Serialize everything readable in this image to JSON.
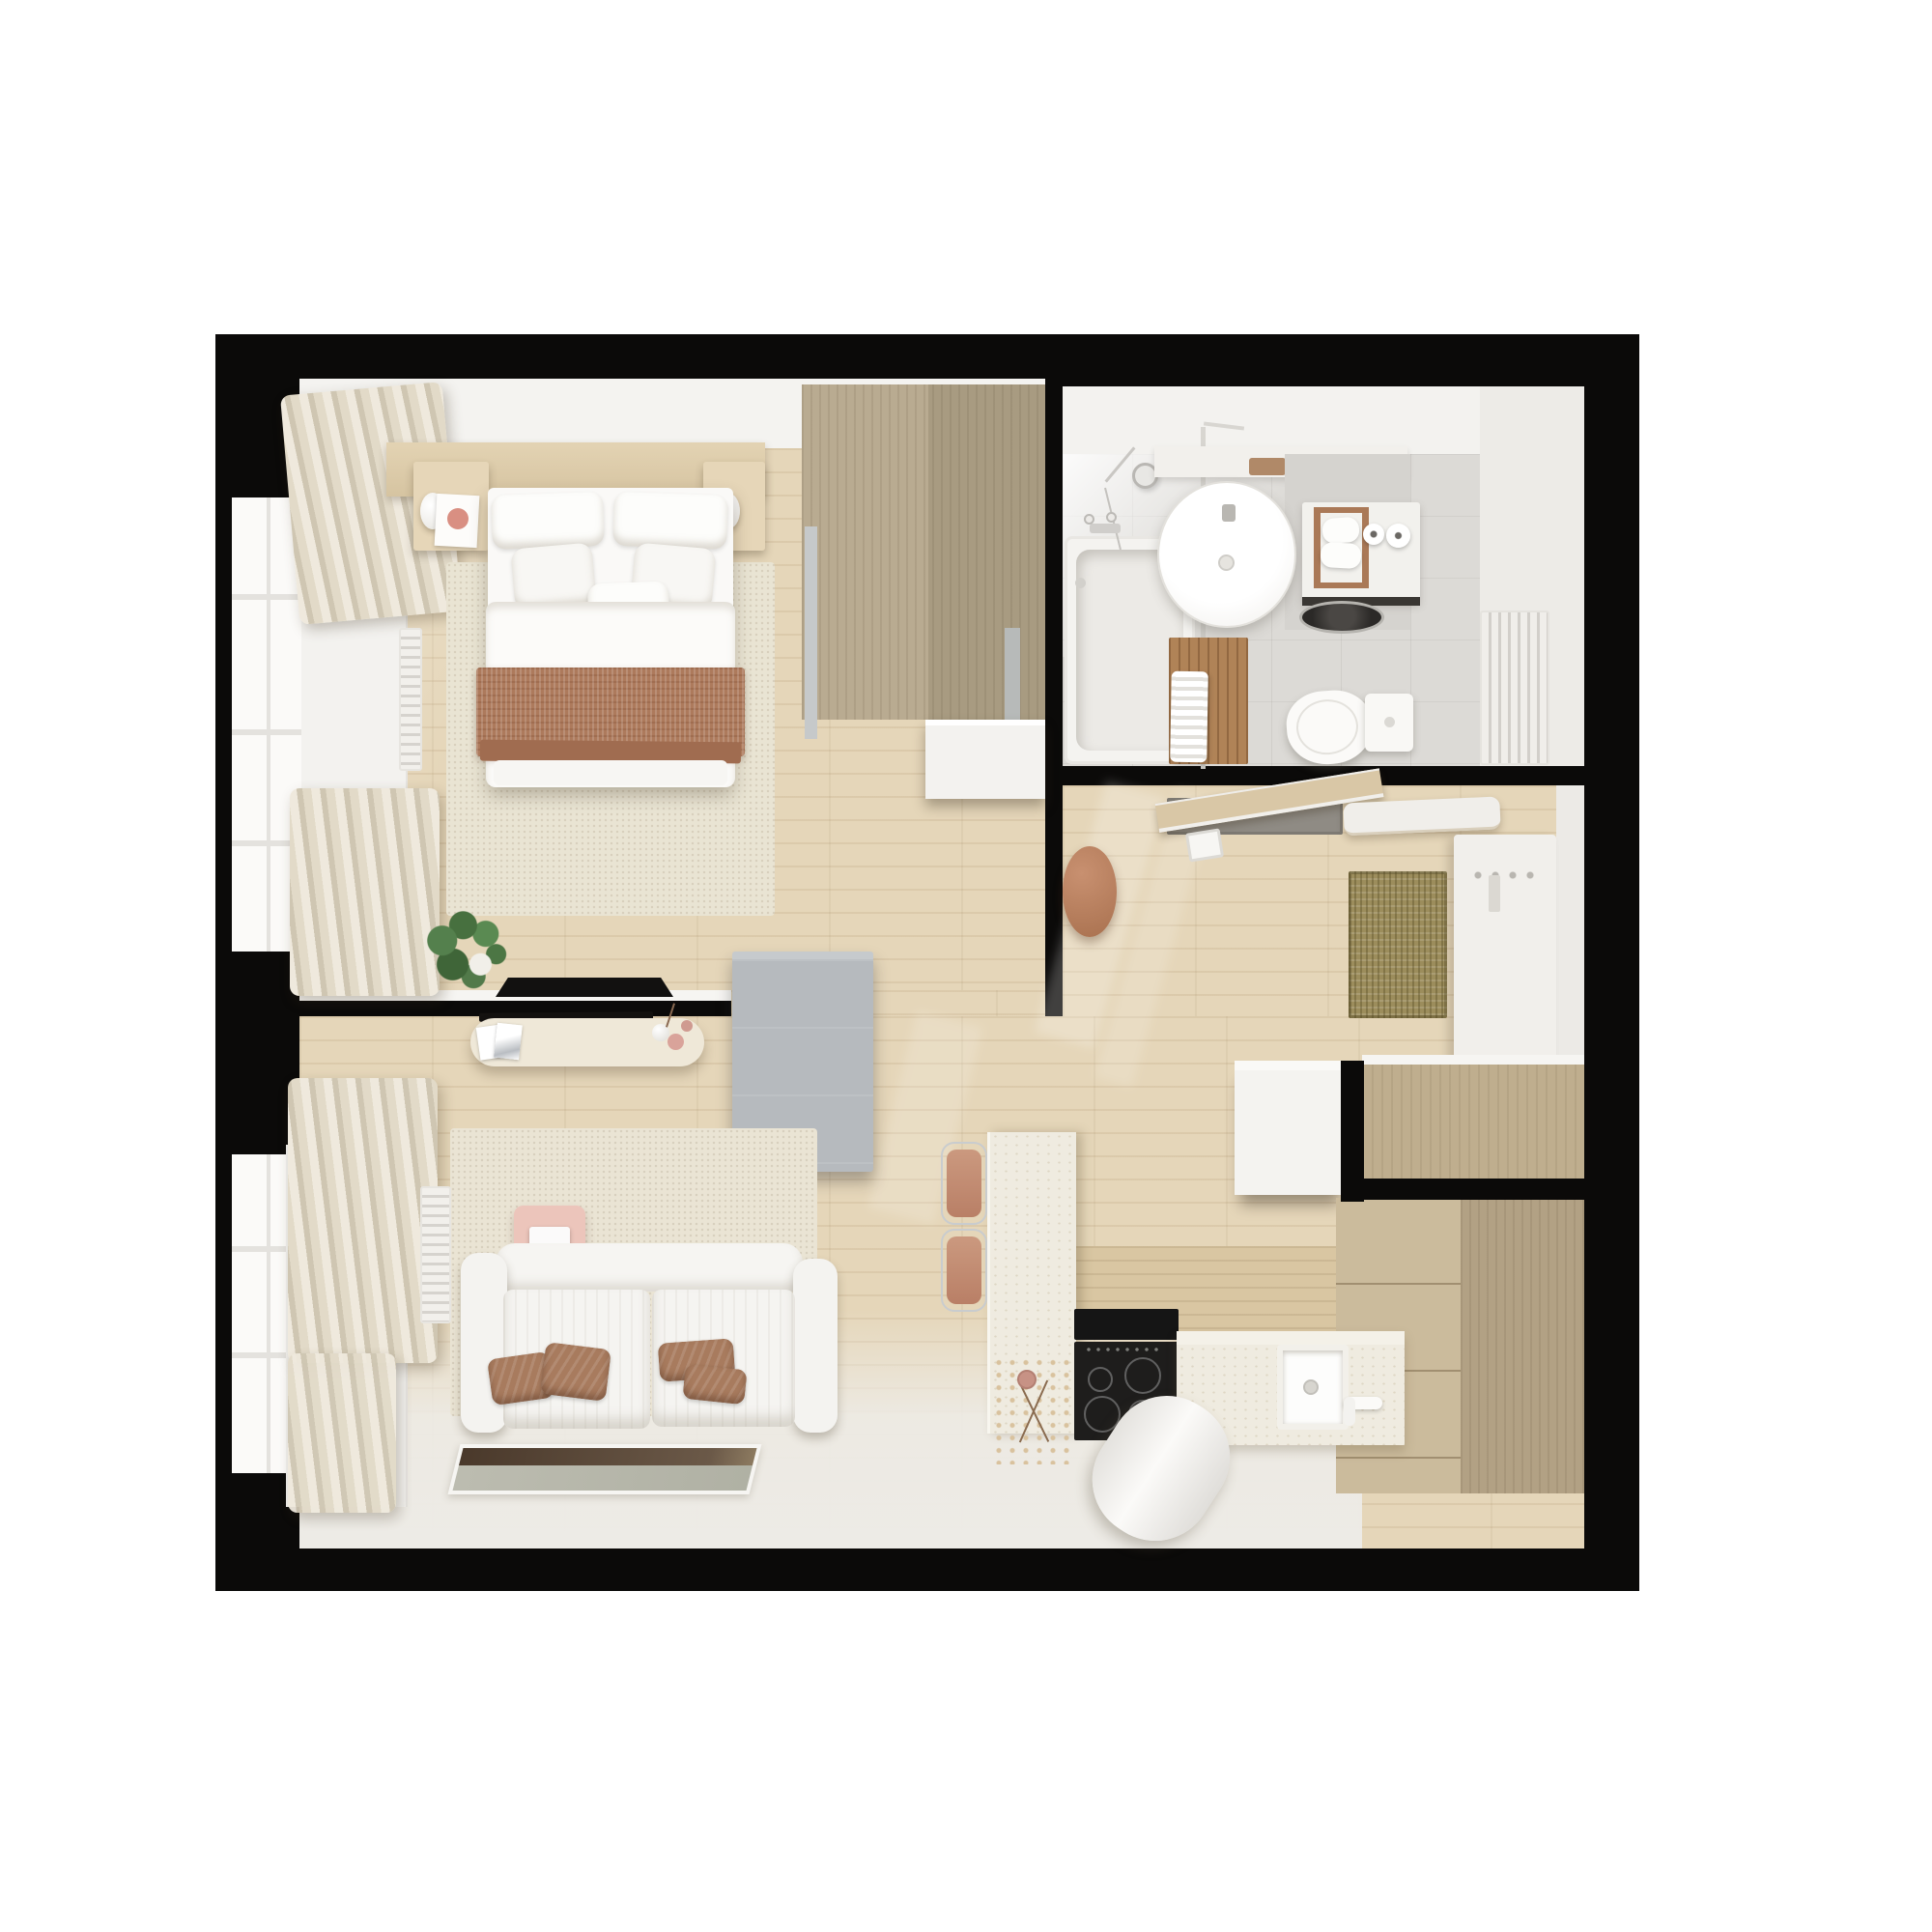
{
  "scene": {
    "type": "3d-floorplan-render",
    "title": "Top-down 3D render of a small one-bedroom apartment floor plan",
    "style": "Minimalist interior in white, beige and terracotta tones",
    "background": "#ffffff"
  },
  "palette": {
    "walls": "#0b0a09",
    "wood_floor": "#e5d6b9",
    "white_wall_faces": "#f4f3f0",
    "bathroom_floor": "#dcdad6",
    "wardrobe_tan": "#b0a287",
    "kitchen_cabinet_tan": "#c4b394",
    "terracotta_blanket": "#ad7a5c",
    "brown_pillows": "#a87b5e",
    "sofa_white": "#f5f4f1",
    "rug_beige": "#e9e4d3",
    "gray_door_panel": "#b6babe",
    "pouf_terracotta": "#b47e62",
    "sisal_mat_olive": "#9c8d5c",
    "cooktop_black": "#1e1d1c",
    "pink_accent": "#ecc5bb",
    "plant_green": "#54804d"
  },
  "rooms": {
    "bedroom": {
      "name": "Bedroom",
      "items": [
        "Double bed with white bedding and terracotta throw blanket",
        "Headboard shelf with two wall lamps",
        "Left nightstand with books",
        "Right nightstand",
        "Beige area rug",
        "Window with beige curtains",
        "Wall radiator",
        "Potted plant",
        "Black serving tray on ledge",
        "Tan wardrobe with handle strips",
        "White dresser"
      ]
    },
    "bathroom": {
      "name": "Bathroom",
      "items": [
        "Bathtub with shower set",
        "Glass shower screen",
        "Round washbasin with vanity shelf",
        "Washing machine with dark drum",
        "Towel ladder with rolled white towels",
        "Two toilet paper rolls",
        "Toilet with cistern",
        "Towel radiator",
        "Wooden bath mat with white towel"
      ]
    },
    "hallway": {
      "name": "Entrance hallway",
      "items": [
        "Entry door ajar",
        "Gray doormat",
        "White coat shelf",
        "Coat panel with hooks",
        "Sisal runner rug",
        "Terracotta pouf",
        "White floating sideboard",
        "Sunlight streaks on wood floor"
      ]
    },
    "kitchen": {
      "name": "Kitchen",
      "items": [
        "Stone peninsula with dried flower vase",
        "Two bar stools with terracotta seats",
        "Black induction cooktop with four burners",
        "Stone countertop",
        "Square white sink with faucet",
        "Tall beige cabinet columns",
        "White wall cabinet",
        "White cylindrical pouf on floor"
      ]
    },
    "living_room": {
      "name": "Living room",
      "items": [
        "White two-seat sofa with brown cushions",
        "Beige area rug",
        "Pink wall console with speaker",
        "White console shelf with magazines and vases",
        "Floor artwork mat",
        "Gray door panel at bedroom doorway",
        "Window radiator",
        "Beige curtains"
      ]
    }
  }
}
